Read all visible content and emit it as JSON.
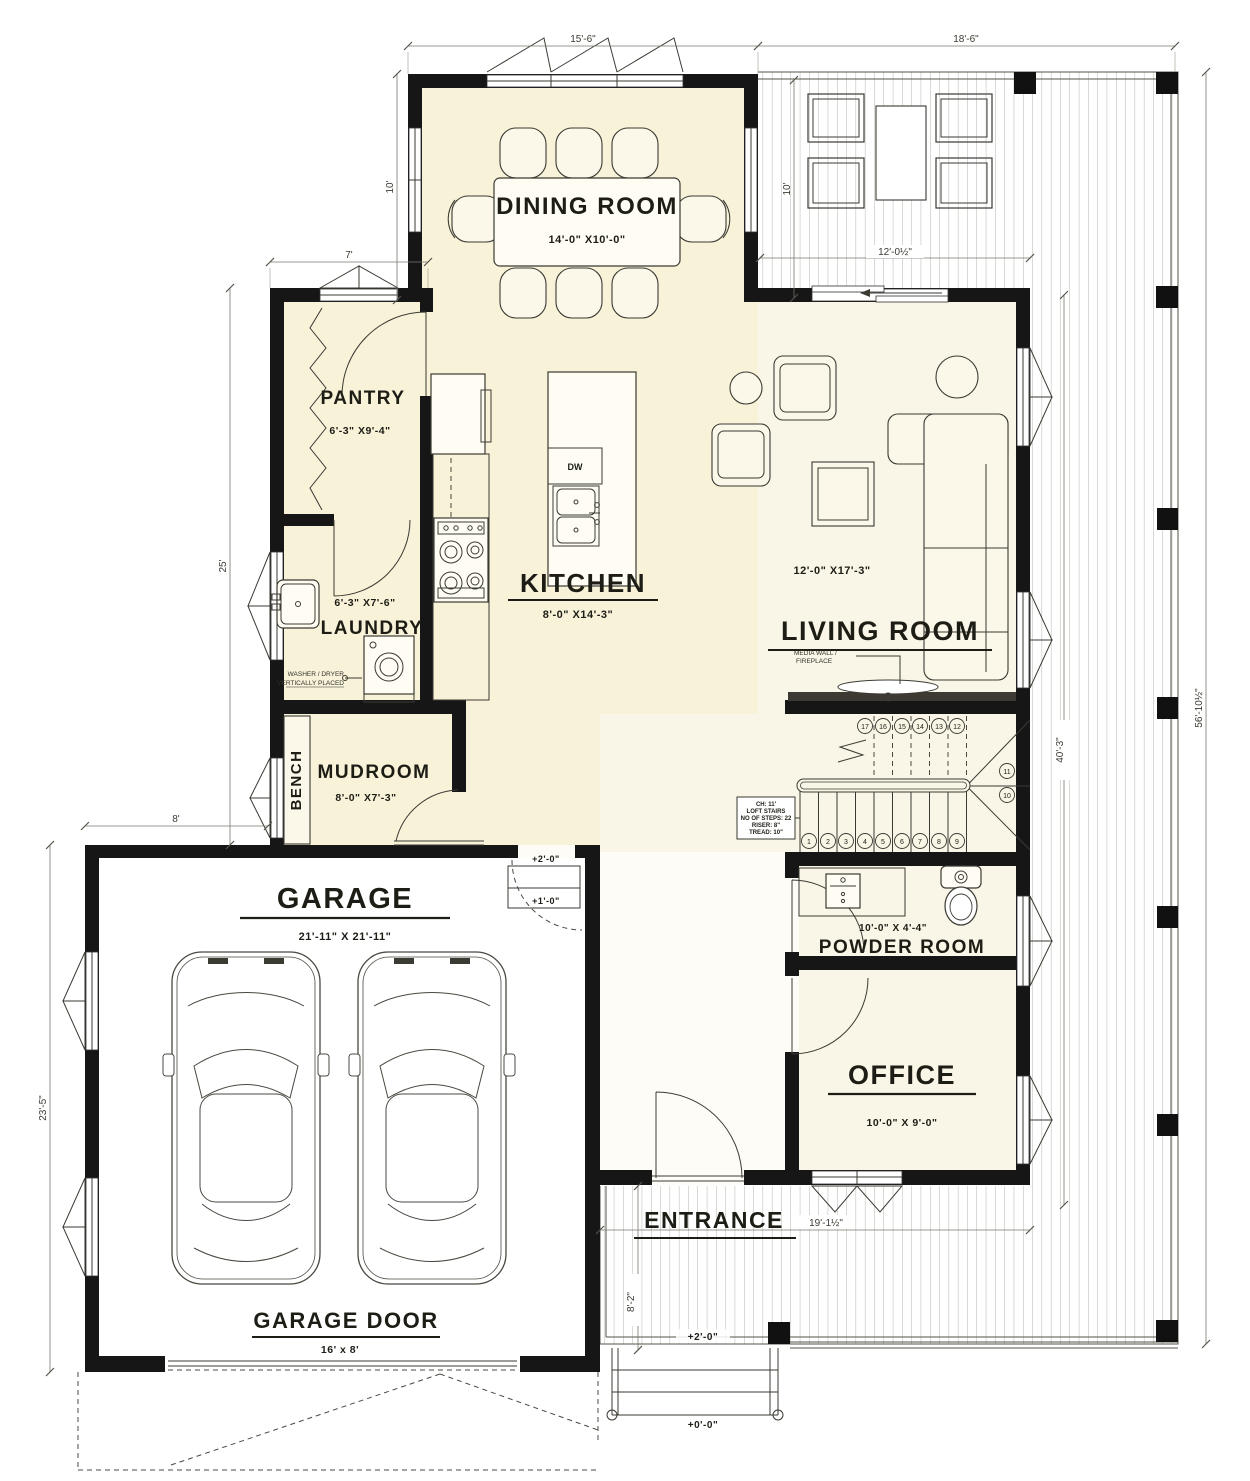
{
  "colors": {
    "paper": "#ffffff",
    "wall": "#161616",
    "room_yellow": "#F7F2D8",
    "room_cream": "#FAF6E7",
    "deck_plank": "#AEABA1",
    "ink": "#1D1D16"
  },
  "rooms": {
    "dining": {
      "name": "DINING ROOM",
      "size": "14'-0\" X10'-0\""
    },
    "pantry": {
      "name": "PANTRY",
      "size": "6'-3\" X9'-4\""
    },
    "laundry": {
      "name": "LAUNDRY",
      "size": "6'-3\" X7'-6\""
    },
    "kitchen": {
      "name": "KITCHEN",
      "size": "8'-0\" X14'-3\""
    },
    "living": {
      "name": "LIVING ROOM",
      "size": "12'-0\" X17'-3\""
    },
    "mudroom": {
      "name": "MUDROOM",
      "size": "8'-0\" X7'-3\""
    },
    "bench": {
      "name": "BENCH"
    },
    "garage": {
      "name": "GARAGE",
      "size": "21'-11\" X 21'-11\""
    },
    "garage_door": {
      "name": "GARAGE DOOR",
      "size": "16' x 8'"
    },
    "powder": {
      "name": "POWDER ROOM",
      "size": "10'-0\" X 4'-4\""
    },
    "office": {
      "name": "OFFICE",
      "size": "10'-0\" X 9'-0\""
    },
    "entrance": {
      "name": "ENTRANCE"
    }
  },
  "annotations": {
    "washer_line1": "WASHER / DRYER",
    "washer_line2": "VERTICALLY PLACED",
    "media_line1": "MEDIA WALL /",
    "media_line2": "FIREPLACE",
    "dishwasher": "DW",
    "stair_note": [
      "CH: 11'",
      "LOFT STAIRS",
      "NO OF STEPS: 22",
      "RISER: 8\"",
      "TREAD: 10\""
    ]
  },
  "dimensions": {
    "top_left": "15'-6\"",
    "top_right": "18'-6\"",
    "dining_depth": "10'",
    "pantry_width": "7'",
    "left_height": "25'",
    "garage_offset": "8'",
    "garage_height": "23'-5\"",
    "deck_depth": "10'",
    "deck_width": "12'-0½\"",
    "deck_height": "40'-3\"",
    "overall_height": "56'-10½\"",
    "entrance_width": "19'-1½\"",
    "entrance_depth": "8'-2\""
  },
  "elevations": {
    "garage_landing": "+2'-0\"",
    "garage_step": "+1'-0\"",
    "entry_deck": "+2'-0\"",
    "ground": "+0'-0\""
  },
  "stairs": {
    "numbers": [
      "1",
      "2",
      "3",
      "4",
      "5",
      "6",
      "7",
      "8",
      "9",
      "10",
      "11",
      "12",
      "13",
      "14",
      "15",
      "16",
      "17"
    ]
  }
}
